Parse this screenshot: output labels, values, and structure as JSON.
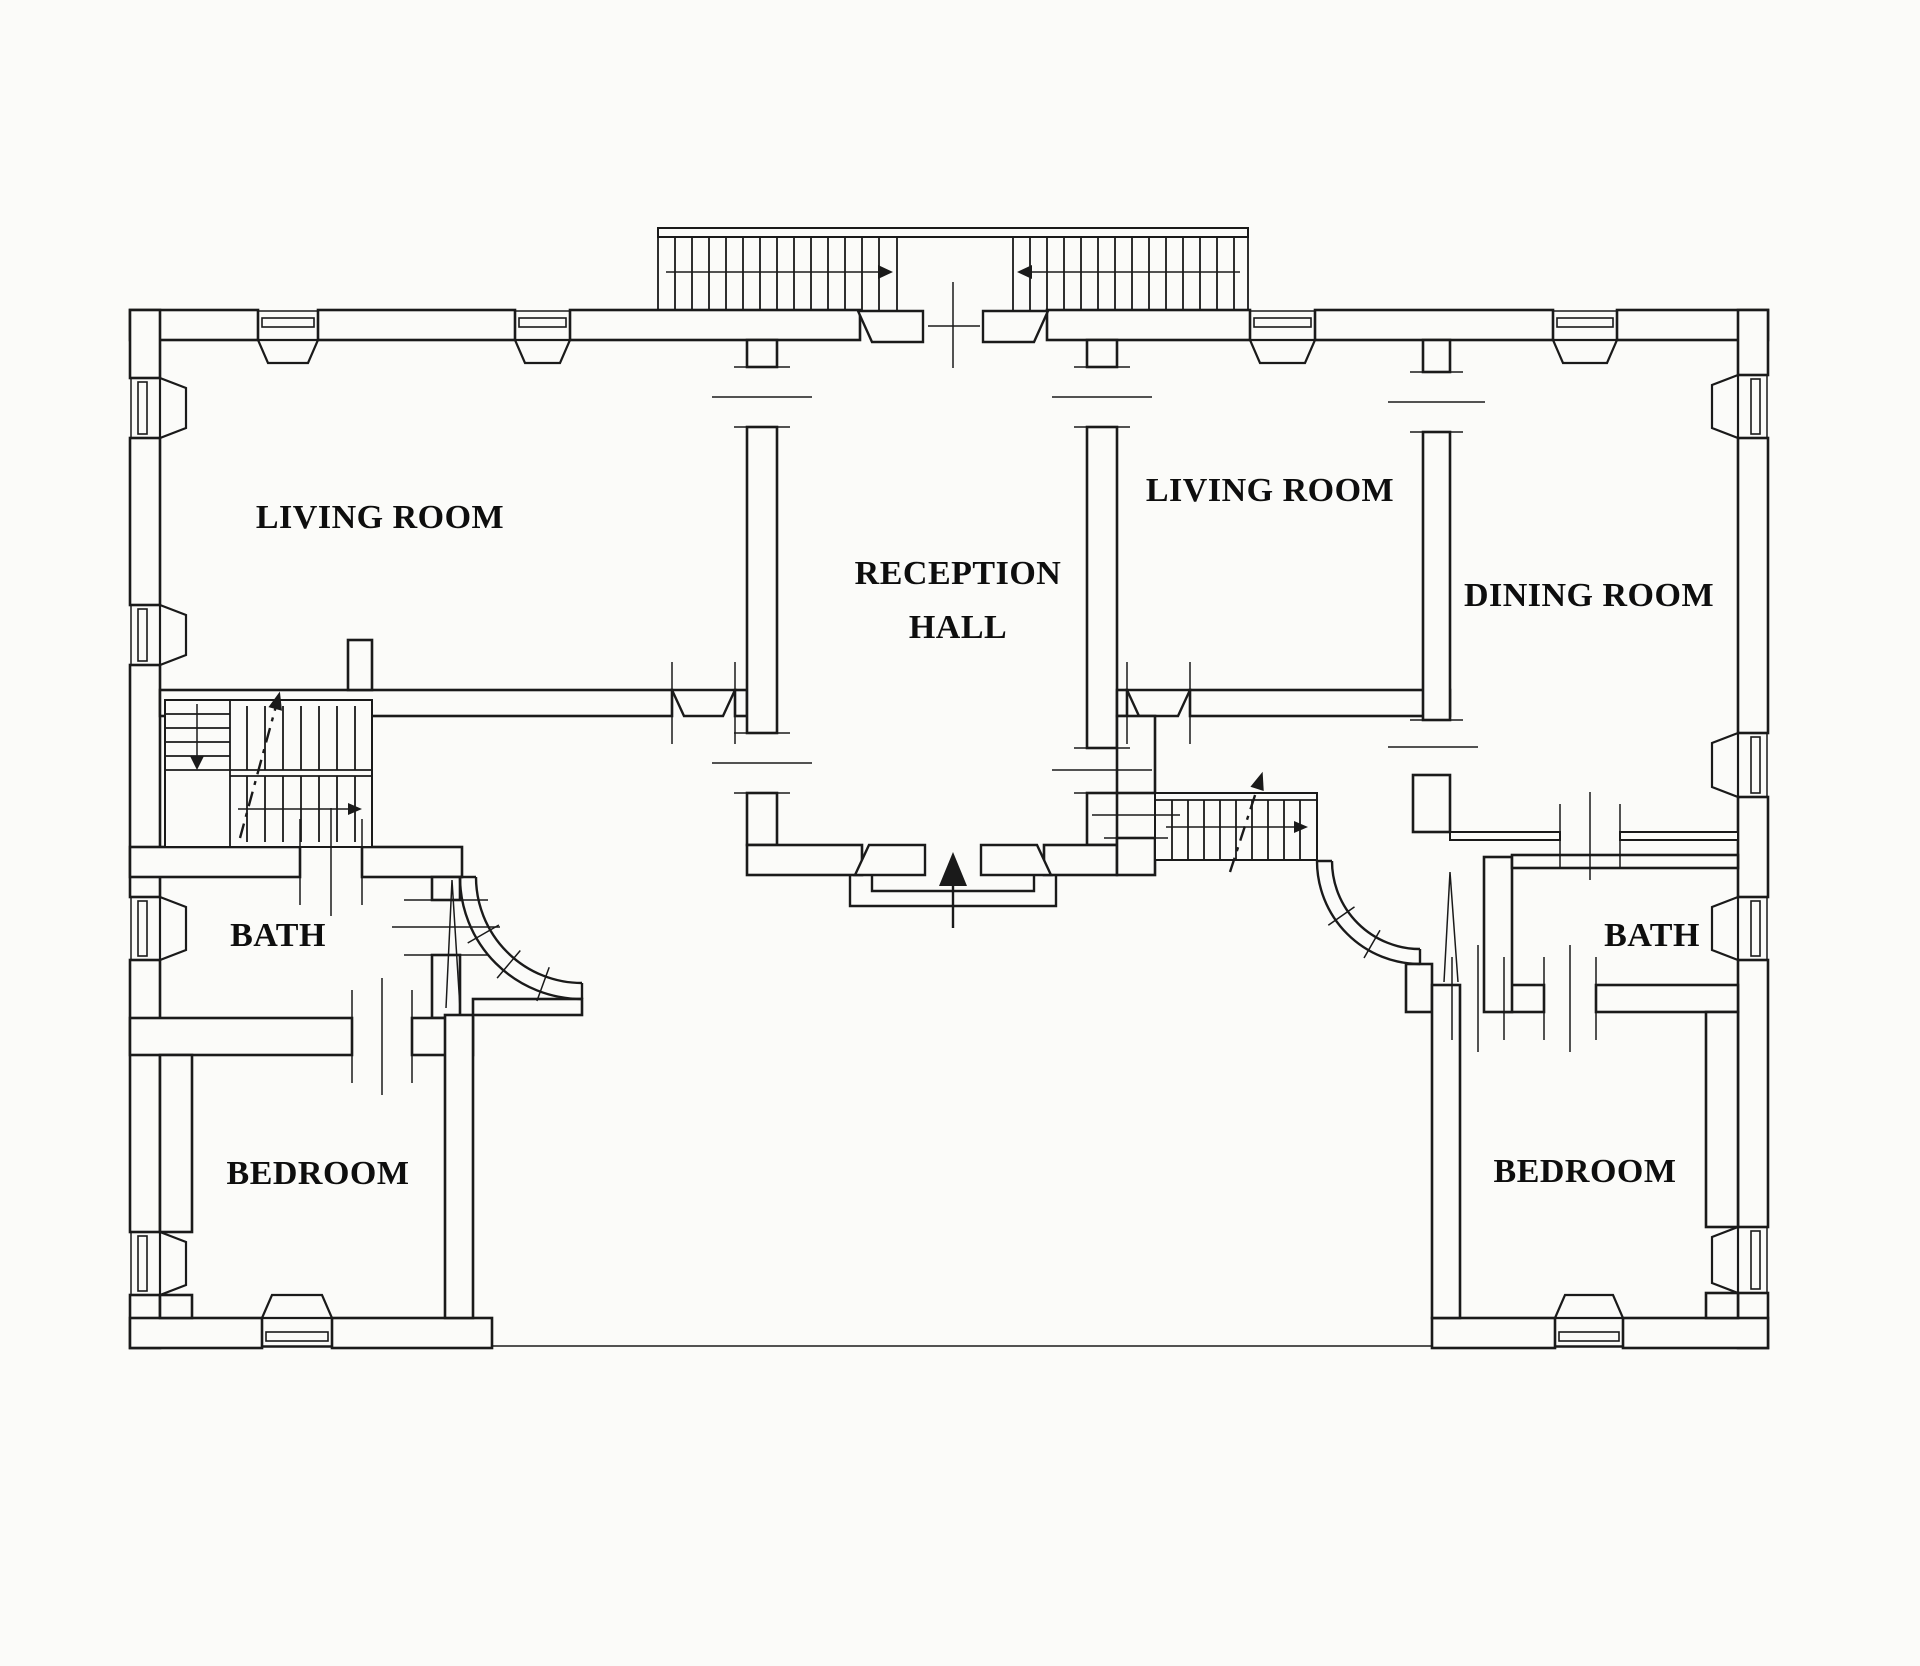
{
  "meta": {
    "type": "architectural-floor-plan"
  },
  "colors": {
    "paper": "#fbfbf9",
    "line": "#1a1a1a",
    "text": "#0e0e0e"
  },
  "rooms": [
    {
      "name": "living-room-left",
      "label": "LIVING ROOM"
    },
    {
      "name": "reception-hall",
      "label_line1": "RECEPTION",
      "label_line2": "HALL"
    },
    {
      "name": "living-room-right",
      "label": "LIVING ROOM"
    },
    {
      "name": "dining-room",
      "label": "DINING ROOM"
    },
    {
      "name": "bath-left",
      "label": "BATH"
    },
    {
      "name": "bath-right",
      "label": "BATH"
    },
    {
      "name": "bedroom-left",
      "label": "BEDROOM"
    },
    {
      "name": "bedroom-right",
      "label": "BEDROOM"
    }
  ]
}
